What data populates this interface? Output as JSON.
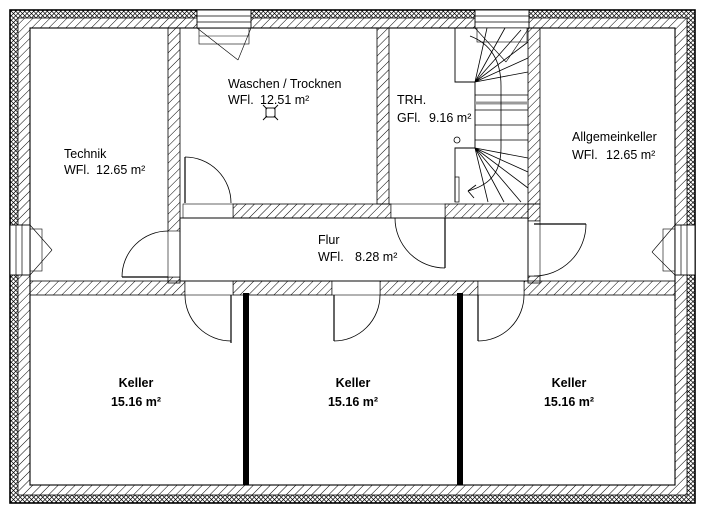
{
  "rooms": {
    "technik": {
      "name": "Technik",
      "area_label": "WFl.",
      "area": "12.65 m²"
    },
    "waschen": {
      "name": "Waschen / Trocknen",
      "area_label": "WFl.",
      "area": "12.51 m²"
    },
    "trh": {
      "name": "TRH.",
      "area_label": "GFl.",
      "area": "9.16 m²"
    },
    "allgemeinkeller": {
      "name": "Allgemeinkeller",
      "area_label": "WFl.",
      "area": "12.65 m²"
    },
    "flur": {
      "name": "Flur",
      "area_label": "WFl.",
      "area": "8.28 m²"
    },
    "keller1": {
      "name": "Keller",
      "area": "15.16 m²"
    },
    "keller2": {
      "name": "Keller",
      "area": "15.16 m²"
    },
    "keller3": {
      "name": "Keller",
      "area": "15.16 m²"
    }
  },
  "colors": {
    "line": "#000000",
    "background": "#ffffff",
    "section_line": "#9a9a9a"
  },
  "icons": {
    "floor_drain": "floor-drain symbol in Waschen / Trocknen",
    "stair_arrow": "stair direction arrow"
  }
}
